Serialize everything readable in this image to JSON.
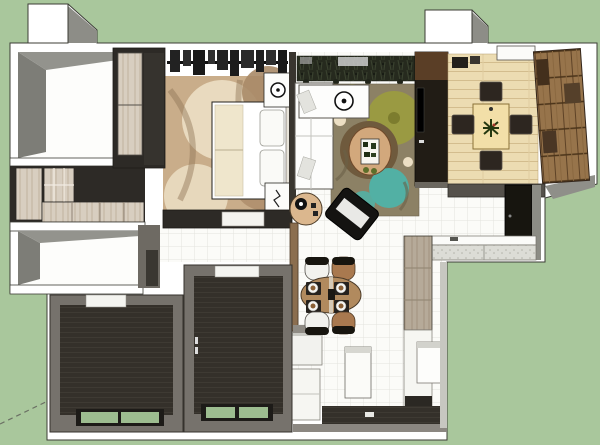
{
  "scene": {
    "type": "3d-floor-plan-render",
    "view": "top-down sketchup style dollhouse render of an apartment",
    "rooms": [
      {
        "name": "storage-room-upper-left"
      },
      {
        "name": "walk-in-closet"
      },
      {
        "name": "storage-room-lower-left"
      },
      {
        "name": "master-bedroom"
      },
      {
        "name": "living-room"
      },
      {
        "name": "tatami-room"
      },
      {
        "name": "kitchen"
      },
      {
        "name": "dining-area"
      },
      {
        "name": "hallway"
      },
      {
        "name": "bedroom-2"
      },
      {
        "name": "bedroom-3"
      },
      {
        "name": "balcony-strip"
      }
    ],
    "furniture": [
      "wardrobe",
      "clothes-rail",
      "double-bed",
      "nightstand",
      "bedroom-rug",
      "l-shaped-sofa",
      "round-tray",
      "area-rug",
      "coffee-table",
      "floor-pouf",
      "side-table",
      "tv-wall",
      "low-tea-table",
      "floor-cushions",
      "wood-bookshelf",
      "kitchen-counter",
      "tall-cabinet",
      "refrigerator",
      "island-cabinet",
      "dining-table",
      "dining-chairs",
      "place-settings",
      "windows"
    ]
  },
  "palette": {
    "background": "#a9c79c",
    "wall_white": "#ffffff",
    "wall_gray": "#8c8c86",
    "wall_dark": "#57534d",
    "room_wall_gray": "#76726c",
    "dark_wall": "#2d2a26",
    "dark_floor": "#34302a",
    "tile_floor": "#fbfbf8",
    "tile_line": "#e3e3de",
    "tatami_floor": "#ecdcb2",
    "plank_line": "#d3bd8e",
    "wood_light": "#d8cec0",
    "wood_gray": "#b6aa99",
    "shelf_wood": "#97744b",
    "rug_base": "#8c8165",
    "rug_olive": "#9a9a42",
    "rug_teal": "#52b0a4",
    "rug_brown": "#6f5a3d",
    "bedroom_rug_base": "#c9ad8a",
    "bedroom_rug_cream": "#ecdfc4",
    "bedroom_rug_tan": "#a98a67",
    "sofa_white": "#fdfdfc",
    "black_furniture": "#17150f",
    "tv_wood": "#5a3e26",
    "partition_brown": "#8b6e4f",
    "table_wood": "#b18a5e",
    "chair_brown": "#a9794f",
    "cushion_dark": "#2d2620",
    "tatami_table": "#f2dfa8",
    "coffee_table_tan": "#d2a87c",
    "counter_speckle": "#dcdcd6",
    "foliage_dark": "#262a1e",
    "green_pane": "#9dbd90",
    "axis_line": "#6b7064"
  }
}
